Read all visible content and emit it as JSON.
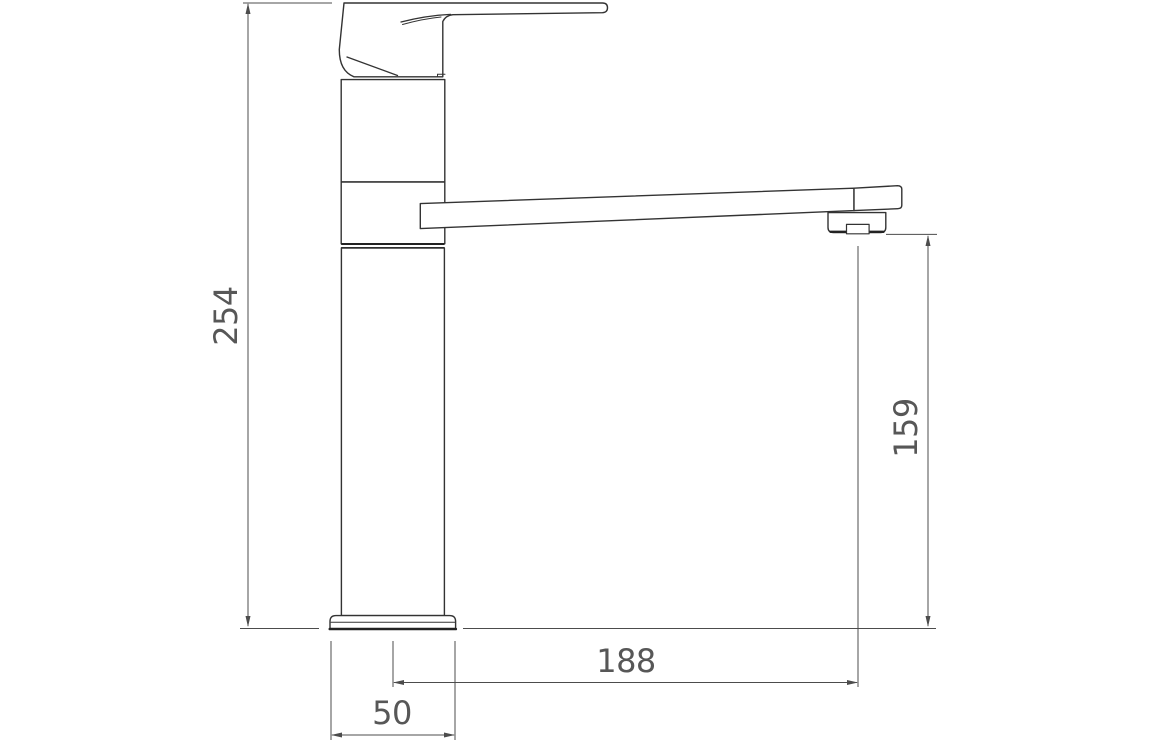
{
  "drawing": {
    "dimensions": {
      "overall_height": "254",
      "spout_height": "159",
      "spout_reach": "188",
      "base_width": "50"
    },
    "colors": {
      "line": "#333333",
      "dark": "#222222",
      "dim": "#4c4c4c",
      "text": "#575757",
      "background": "#ffffff"
    }
  }
}
